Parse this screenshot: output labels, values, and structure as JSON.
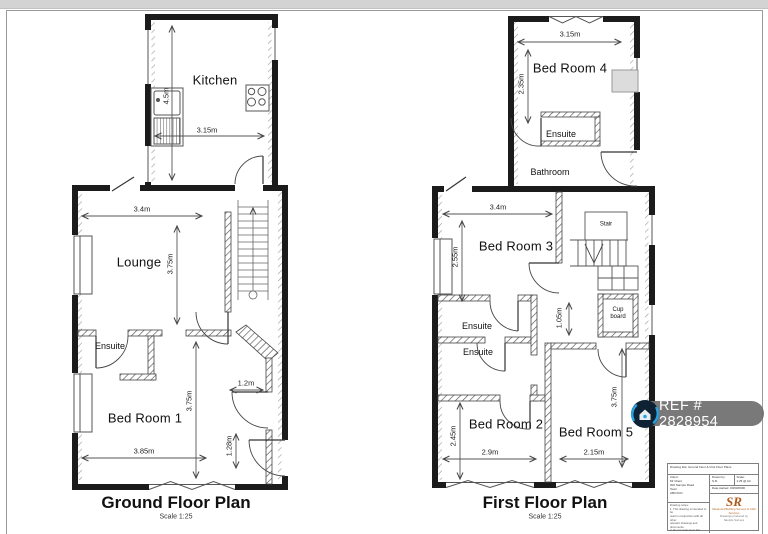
{
  "page": {
    "colors": {
      "wall": "#1b1b1b",
      "top_strip": "#d3d3d3",
      "sheet_border": "#9a9a9a",
      "badge_bg": "#6e6e6e",
      "badge_icon_bg": "#0e2233",
      "badge_icon_accent": "#2aa2de",
      "logo_orange": "#b05a1e",
      "furniture_gray": "#dcdcdc"
    }
  },
  "ground_floor": {
    "title": "Ground Floor Plan",
    "scale": "Scale 1:25",
    "rooms": {
      "kitchen": "Kitchen",
      "lounge": "Lounge",
      "ensuite": "Ensuite",
      "bedroom1": "Bed Room 1"
    },
    "dims": {
      "kitchen_height": "4.5m",
      "kitchen_width": "3.15m",
      "lounge_width": "3.4m",
      "lounge_height": "3.75m",
      "bedroom1_height": "3.75m",
      "bedroom1_width": "3.85m",
      "hall_width": "1.2m",
      "hall_depth": "1.28m"
    }
  },
  "first_floor": {
    "title": "First Floor Plan",
    "scale": "Scale 1:25",
    "rooms": {
      "bedroom4": "Bed Room 4",
      "ensuite_top": "Ensuite",
      "bathroom": "Bathroom",
      "bedroom3": "Bed Room 3",
      "stair": "Stair",
      "cupboard_line1": "Cup",
      "cupboard_line2": "board",
      "ensuite_mid": "Ensuite",
      "ensuite_lower": "Ensuite",
      "bedroom2": "Bed Room 2",
      "bedroom5": "Bed Room 5"
    },
    "dims": {
      "bedroom4_width": "3.15m",
      "bedroom4_height": "2.35m",
      "bedroom3_width": "3.4m",
      "bedroom3_height": "2.55m",
      "landing": "1.05m",
      "bedroom2_height": "2.45m",
      "bedroom2_width": "2.9m",
      "bedroom5_width": "2.15m",
      "bedroom5_height": "3.75m"
    }
  },
  "ref_badge": {
    "text": "REF # 2828954"
  },
  "title_block": {
    "project_line": "Drawing title:  Ground Floor & First Floor Plans",
    "client_label": "Client:",
    "client_lines": [
      "Mr Client",
      "000 Sample Road",
      "Town",
      "AB0 0CD"
    ],
    "drawn_by_label": "Drawn by:",
    "drawn_by_value": "S.R.",
    "scale_label": "Scale:",
    "scale_value": "1:25 @ A4",
    "date_label": "Date started:",
    "date_value": "00/00/0000",
    "notes_label": "Drawing notes:",
    "notes_lines": [
      "1. This drawing is intended to be",
      "read in conjunction with all other",
      "relevant drawings and documents.",
      "2. Do not scale from this drawing.",
      "3. All dimensions to be checked",
      "on site prior to any works."
    ],
    "logo_monogram": "SR",
    "logo_lines": [
      "Measured Building Surveys & CAD",
      "Services"
    ],
    "logo_sub_lines": [
      "Drawings produced by",
      "Sample Surveys"
    ]
  }
}
